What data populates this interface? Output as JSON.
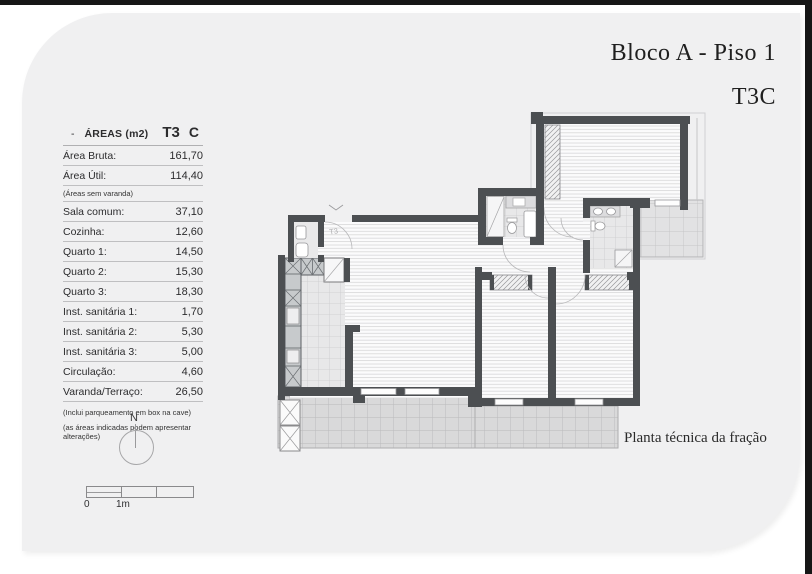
{
  "header": {
    "title": "Bloco A - Piso 1",
    "subtitle": "T3C"
  },
  "areas_table": {
    "dash": "-",
    "title": "ÁREAS (m2)",
    "col_type": "T3",
    "col_variant": "C",
    "rows": [
      {
        "label": "Área Bruta:",
        "value": "161,70"
      },
      {
        "label": "Área Útil:",
        "value": "114,40"
      },
      {
        "label": "Sala comum:",
        "value": "37,10"
      },
      {
        "label": "Cozinha:",
        "value": "12,60"
      },
      {
        "label": "Quarto 1:",
        "value": "14,50"
      },
      {
        "label": "Quarto 2:",
        "value": "15,30"
      },
      {
        "label": "Quarto 3:",
        "value": "18,30"
      },
      {
        "label": "Inst. sanitária 1:",
        "value": "1,70"
      },
      {
        "label": "Inst. sanitária 2:",
        "value": "5,30"
      },
      {
        "label": "Inst. sanitária 3:",
        "value": "5,00"
      },
      {
        "label": "Circulação:",
        "value": "4,60"
      },
      {
        "label": "Varanda/Terraço:",
        "value": "26,50"
      }
    ],
    "note": "(Áreas sem varanda)",
    "footnotes": [
      "(Inclui parqueamento em box na cave)",
      "(as áreas indicadas podem apresentar alterações)"
    ]
  },
  "plan": {
    "entrance_label": "T3",
    "caption": "Planta técnica da fração"
  },
  "north": {
    "label": "N"
  },
  "scale_bar": {
    "start": "0",
    "mid": "1m"
  },
  "colors": {
    "wall": "#4c4f52",
    "panel": "#f0f0f1",
    "ink": "#1f1f1f"
  }
}
